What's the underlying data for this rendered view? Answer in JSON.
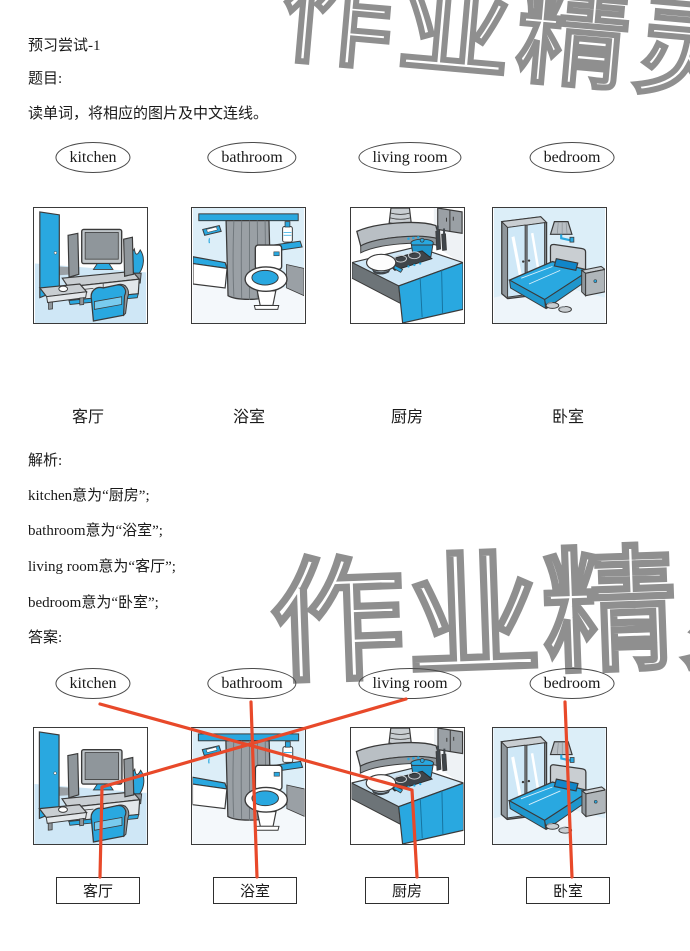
{
  "header": {
    "title": "预习尝试-1",
    "question_label": "题目:",
    "question_text": "读单词，将相应的图片及中文连线。"
  },
  "words": [
    "kitchen",
    "bathroom",
    "living room",
    "bedroom"
  ],
  "room_labels": [
    "客厅",
    "浴室",
    "厨房",
    "卧室"
  ],
  "pictures": [
    "living-room",
    "bathroom",
    "kitchen",
    "bedroom"
  ],
  "analysis": {
    "label": "解析:",
    "lines": [
      "kitchen意为“厨房”;",
      "bathroom意为“浴室”;",
      "living room意为“客厅”;",
      "bedroom意为“卧室”;"
    ]
  },
  "answer": {
    "label": "答案:",
    "connections": [
      {
        "word": "kitchen",
        "chinese": "厨房"
      },
      {
        "word": "bathroom",
        "chinese": "浴室"
      },
      {
        "word": "living room",
        "chinese": "客厅"
      },
      {
        "word": "bedroom",
        "chinese": "卧室"
      }
    ]
  },
  "watermark": {
    "text": "作业精灵"
  },
  "colors": {
    "connection_line": "#e8492a",
    "illustration_blue": "#29a8e0",
    "illustration_light_blue": "#dceef8",
    "illustration_gray": "#9aa0a5",
    "watermark_outline": "#8f8f8f"
  }
}
